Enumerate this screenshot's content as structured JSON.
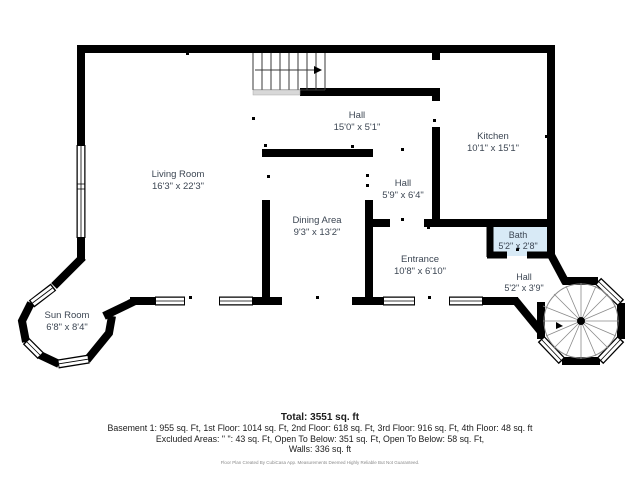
{
  "plan": {
    "rooms": [
      {
        "name": "Hall",
        "dims": "15'0\" x 5'1\""
      },
      {
        "name": "Kitchen",
        "dims": "10'1\" x 15'1\""
      },
      {
        "name": "Living Room",
        "dims": "16'3\" x 22'3\""
      },
      {
        "name": "Hall",
        "dims": "5'9\" x 6'4\""
      },
      {
        "name": "Dining Area",
        "dims": "9'3\" x 13'2\""
      },
      {
        "name": "Entrance",
        "dims": "10'8\" x 6'10\""
      },
      {
        "name": "Bath",
        "dims": "5'2\" x 2'8\""
      },
      {
        "name": "Hall",
        "dims": "5'2\" x 3'9\""
      },
      {
        "name": "Sun Room",
        "dims": "6'8\" x 8'4\""
      }
    ],
    "colors": {
      "wall": "#000000",
      "bath_fill": "#d8eaf6",
      "label_text": "#3c4653",
      "stair_line": "#3a3a3a",
      "spiral_line": "#8a8a8a"
    }
  },
  "footer": {
    "total": "Total: 3551 sq. ft",
    "floors": "Basement 1: 955 sq. Ft, 1st Floor: 1014 sq. Ft, 2nd Floor: 618 sq. Ft, 3rd Floor: 916 sq. Ft, 4th Floor: 48 sq. ft",
    "excluded": "Excluded Areas: \" \": 43 sq. Ft, Open To Below: 351 sq. Ft, Open To Below: 58 sq. Ft,",
    "walls": "Walls: 336 sq. ft",
    "disclaimer": "Floor Plan Created By CubiCasa App. Measurements Deemed Highly Reliable But Not Guaranteed."
  }
}
